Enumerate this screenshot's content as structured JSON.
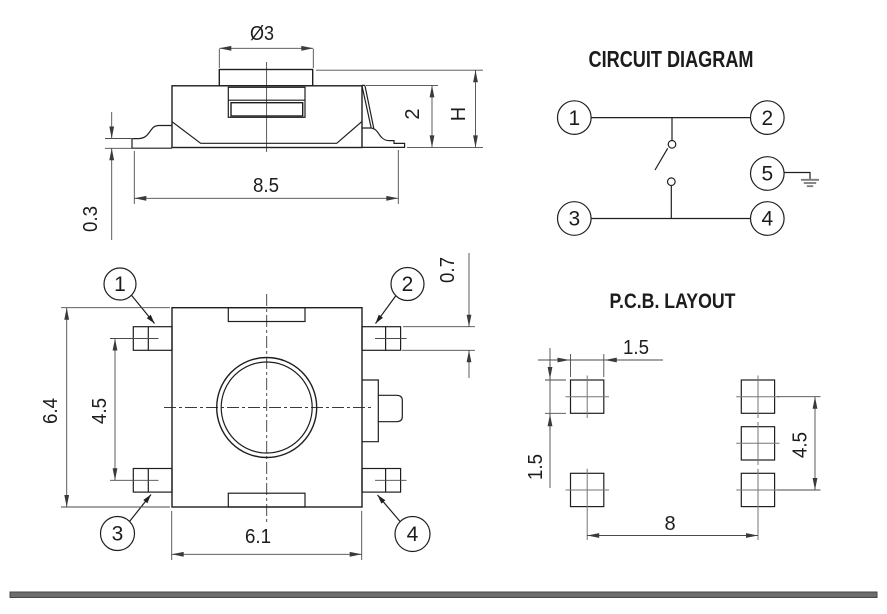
{
  "drawing": {
    "side_view": {
      "label_button_diameter": "Ø3",
      "label_body_width": "8.5",
      "label_lead_thickness": "0.3",
      "label_body_height": "2",
      "label_total_height": "H"
    },
    "top_view": {
      "label_overall_width": "6.4",
      "label_lead_pitch": "4.5",
      "label_body_width": "6.1",
      "label_lead_width": "0.7",
      "callouts": [
        "1",
        "2",
        "3",
        "4"
      ]
    },
    "circuit": {
      "title": "CIRCUIT DIAGRAM",
      "terminals": [
        "1",
        "2",
        "3",
        "4",
        "5"
      ]
    },
    "pcb": {
      "title": "P.C.B. LAYOUT",
      "label_pad_width": "1.5",
      "label_pad_height": "1.5",
      "label_row_pitch": "4.5",
      "label_col_pitch": "8"
    },
    "colors": {
      "line": "#1f1f1f",
      "dimension": "#4a4a4a",
      "ground_symbol": "#7a7a7a",
      "divider_bar": "#6d6d6d"
    }
  }
}
